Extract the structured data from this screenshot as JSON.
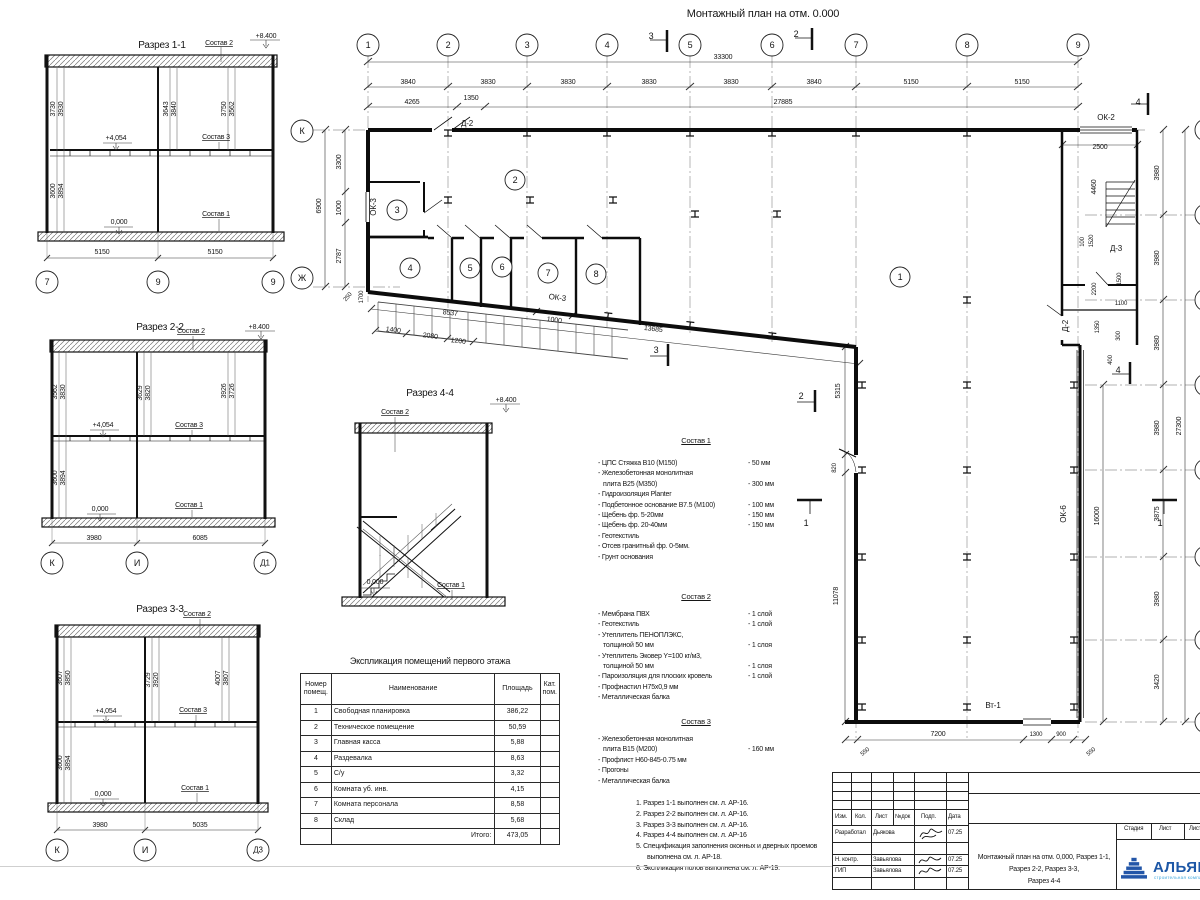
{
  "plan_title": "Монтажный план на отм. 0.000",
  "explication": {
    "title": "Экспликация помещений первого этажа",
    "headers": [
      "Номер помещ.",
      "Наименование",
      "Площадь",
      "Кат. пом."
    ],
    "rows": [
      {
        "n": "1",
        "name": "Свободная планировка",
        "area": "386,22",
        "cat": ""
      },
      {
        "n": "2",
        "name": "Техническое помещение",
        "area": "50,59",
        "cat": ""
      },
      {
        "n": "3",
        "name": "Главная касса",
        "area": "5,88",
        "cat": ""
      },
      {
        "n": "4",
        "name": "Раздевалка",
        "area": "8,63",
        "cat": ""
      },
      {
        "n": "5",
        "name": "С/у",
        "area": "3,32",
        "cat": ""
      },
      {
        "n": "6",
        "name": "Комната уб. инв.",
        "area": "4,15",
        "cat": ""
      },
      {
        "n": "7",
        "name": "Комната персонала",
        "area": "8,58",
        "cat": ""
      },
      {
        "n": "8",
        "name": "Склад",
        "area": "5,68",
        "cat": ""
      },
      {
        "n": "",
        "name": "Итого:",
        "area": "473,05",
        "cat": "",
        "total": 1
      }
    ]
  },
  "sostav1": {
    "title": "Состав 1",
    "items": [
      {
        "t": "- ЦПС Стяжка В10 (М150)",
        "v": "- 50 мм"
      },
      {
        "t": "- Железобетонная монолитная"
      },
      {
        "t": "плита В25 (М350)",
        "v": "- 300 мм",
        "c": 1
      },
      {
        "t": "- Гидроизоляция  Planter"
      },
      {
        "t": "- Подбетонное основание В7.5 (М100)",
        "v": "- 100 мм"
      },
      {
        "t": "- Щебень фр. 5-20мм",
        "v": "- 150 мм"
      },
      {
        "t": "- Щебень фр. 20-40мм",
        "v": "- 150 мм"
      },
      {
        "t": "- Геотекстиль"
      },
      {
        "t": "- Отсев гранитный фр. 0-5мм."
      },
      {
        "t": "- Грунт основания"
      }
    ]
  },
  "sostav2": {
    "title": "Состав 2",
    "items": [
      {
        "t": "- Мембрана ПВХ",
        "v": "- 1 слой"
      },
      {
        "t": "- Геотекстиль",
        "v": "- 1 слой"
      },
      {
        "t": "- Утеплитель ПЕНОПЛЭКС,"
      },
      {
        "t": "толщиной 50 мм",
        "v": "- 1 слоя",
        "c": 1
      },
      {
        "t": "- Утеплитель Эковер Y=100 кг/м3,"
      },
      {
        "t": "толщиной 50 мм",
        "v": "- 1 слоя",
        "c": 1
      },
      {
        "t": "- Пароизоляция для плоских кровель",
        "v": "- 1 слой"
      },
      {
        "t": "- Профнастил Н75х0,9 мм"
      },
      {
        "t": "- Металлическая балка"
      }
    ]
  },
  "sostav3": {
    "title": "Состав 3",
    "items": [
      {
        "t": "- Железобетонная монолитная"
      },
      {
        "t": "плита В15 (М200)",
        "v": "- 160 мм",
        "c": 1
      },
      {
        "t": "- Профлист Н60-845-0.75 мм"
      },
      {
        "t": "- Прогоны"
      },
      {
        "t": "- Металлическая балка"
      }
    ]
  },
  "notes": {
    "items": [
      {
        "t": "1. Разрез 1-1 выполнен см. л. АР-16."
      },
      {
        "t": "2. Разрез 2-2 выполнен см. л. АР-16."
      },
      {
        "t": "3. Разрез 3-3 выполнен см. л. АР-16."
      },
      {
        "t": "4. Разрез 4-4 выполнен см. л. АР-16"
      },
      {
        "t": "5. Спецификация заполнения оконных и дверных проемов выполнена см. л. АР-18."
      },
      {
        "t": "6. Экспликация полов выполнена см. л. АР-19."
      }
    ]
  },
  "titleblock": {
    "cols": [
      "Изм.",
      "Кол.",
      "Лист",
      "№док",
      "Подп.",
      "Дата"
    ],
    "rows": [
      {
        "role": "Разработал",
        "name": "Дьякова",
        "date": "07.25"
      },
      {
        "role": "Н. контр.",
        "name": "Завьялова",
        "date": "07.25"
      },
      {
        "role": "ГИП",
        "name": "Завьялова",
        "date": "07.25"
      }
    ],
    "doc_title": [
      "Монтажный план на отм. 0,000, Разрез 1-1,",
      "Разрез 2-2, Разрез 3-3,",
      "Разрез 4-4"
    ],
    "stage_cols": [
      "Стадия",
      "Лист",
      "Листов"
    ],
    "logo": {
      "name": "АЛЬЯНС",
      "sub": "строительная компания",
      "color": "#1d57a6",
      "sub_color": "#43a9de"
    }
  },
  "svg_texts": {
    "sec11": [
      {
        "t": "Разрез 1-1",
        "x": 162,
        "y": 48,
        "f": 10
      },
      {
        "t": "Состав 2",
        "x": 219,
        "y": 45,
        "u": 1
      },
      {
        "t": "+8.400",
        "x": 266,
        "y": 38
      },
      {
        "t": "3730",
        "x": 55,
        "y": 109,
        "o": -90
      },
      {
        "t": "3930",
        "x": 63,
        "y": 109,
        "o": -90
      },
      {
        "t": "3643",
        "x": 168,
        "y": 109,
        "o": -90
      },
      {
        "t": "3840",
        "x": 176,
        "y": 109,
        "o": -90
      },
      {
        "t": "3750",
        "x": 226,
        "y": 109,
        "o": -90
      },
      {
        "t": "3562",
        "x": 234,
        "y": 109,
        "o": -90
      },
      {
        "t": "+4,054",
        "x": 116,
        "y": 140
      },
      {
        "t": "Состав 3",
        "x": 216,
        "y": 139,
        "u": 1
      },
      {
        "t": "3894",
        "x": 63,
        "y": 191,
        "o": -90
      },
      {
        "t": "3600",
        "x": 55,
        "y": 191,
        "o": -90
      },
      {
        "t": "0,000",
        "x": 119,
        "y": 224
      },
      {
        "t": "Состав 1",
        "x": 216,
        "y": 216,
        "u": 1
      },
      {
        "t": "5150",
        "x": 102,
        "y": 254
      },
      {
        "t": "5150",
        "x": 215,
        "y": 254
      },
      {
        "t": "7",
        "x": 47,
        "y": 282,
        "r": 11,
        "f": 9
      },
      {
        "t": "9",
        "x": 158,
        "y": 282,
        "r": 11,
        "f": 9
      },
      {
        "t": "9",
        "x": 273,
        "y": 282,
        "r": 11,
        "f": 9
      }
    ],
    "sec22": [
      {
        "t": "Разрез 2-2",
        "x": 160,
        "y": 330,
        "f": 10
      },
      {
        "t": "Состав 2",
        "x": 191,
        "y": 333,
        "u": 1
      },
      {
        "t": "+8.400",
        "x": 259,
        "y": 329
      },
      {
        "t": "3562",
        "x": 57,
        "y": 392,
        "o": -90
      },
      {
        "t": "3830",
        "x": 65,
        "y": 392,
        "o": -90
      },
      {
        "t": "3629",
        "x": 142,
        "y": 393,
        "o": -90
      },
      {
        "t": "3820",
        "x": 150,
        "y": 393,
        "o": -90
      },
      {
        "t": "3926",
        "x": 226,
        "y": 391,
        "o": -90
      },
      {
        "t": "3726",
        "x": 234,
        "y": 391,
        "o": -90
      },
      {
        "t": "+4,054",
        "x": 103,
        "y": 427
      },
      {
        "t": "Состав 3",
        "x": 189,
        "y": 427,
        "u": 1
      },
      {
        "t": "3894",
        "x": 65,
        "y": 478,
        "o": -90
      },
      {
        "t": "3600",
        "x": 57,
        "y": 478,
        "o": -90
      },
      {
        "t": "0,000",
        "x": 100,
        "y": 511
      },
      {
        "t": "Состав 1",
        "x": 189,
        "y": 507,
        "u": 1
      },
      {
        "t": "3980",
        "x": 94,
        "y": 540
      },
      {
        "t": "6085",
        "x": 200,
        "y": 540
      },
      {
        "t": "К",
        "x": 52,
        "y": 563,
        "r": 11,
        "f": 9
      },
      {
        "t": "И",
        "x": 137,
        "y": 563,
        "r": 11,
        "f": 9
      },
      {
        "t": "Д1",
        "x": 265,
        "y": 563,
        "r": 11,
        "f": 8
      }
    ],
    "sec33": [
      {
        "t": "Разрез 3-3",
        "x": 160,
        "y": 612,
        "f": 10
      },
      {
        "t": "Состав 2",
        "x": 197,
        "y": 616,
        "u": 1
      },
      {
        "t": "3607",
        "x": 62,
        "y": 678,
        "o": -90
      },
      {
        "t": "3850",
        "x": 70,
        "y": 678,
        "o": -90
      },
      {
        "t": "3729",
        "x": 150,
        "y": 680,
        "o": -90
      },
      {
        "t": "3920",
        "x": 158,
        "y": 680,
        "o": -90
      },
      {
        "t": "4007",
        "x": 220,
        "y": 678,
        "o": -90
      },
      {
        "t": "3807",
        "x": 228,
        "y": 678,
        "o": -90
      },
      {
        "t": "+4,054",
        "x": 106,
        "y": 713
      },
      {
        "t": "Состав 3",
        "x": 193,
        "y": 712,
        "u": 1
      },
      {
        "t": "3894",
        "x": 70,
        "y": 763,
        "o": -90
      },
      {
        "t": "3600",
        "x": 62,
        "y": 763,
        "o": -90
      },
      {
        "t": "0,000",
        "x": 103,
        "y": 796
      },
      {
        "t": "Состав 1",
        "x": 195,
        "y": 790,
        "u": 1
      },
      {
        "t": "3980",
        "x": 100,
        "y": 827
      },
      {
        "t": "5035",
        "x": 200,
        "y": 827
      },
      {
        "t": "К",
        "x": 57,
        "y": 850,
        "r": 11,
        "f": 9
      },
      {
        "t": "И",
        "x": 145,
        "y": 850,
        "r": 11,
        "f": 9
      },
      {
        "t": "Д3",
        "x": 258,
        "y": 850,
        "r": 11,
        "f": 8
      }
    ],
    "sec44": [
      {
        "t": "Разрез 4-4",
        "x": 430,
        "y": 396,
        "f": 10
      },
      {
        "t": "Состав 2",
        "x": 395,
        "y": 414,
        "u": 1
      },
      {
        "t": "+8.400",
        "x": 506,
        "y": 402
      },
      {
        "t": "0,000",
        "x": 375,
        "y": 584
      },
      {
        "t": "Состав 1",
        "x": 451,
        "y": 587,
        "u": 1
      }
    ],
    "plan": [
      {
        "t": "1",
        "x": 368,
        "y": 45,
        "r": 11,
        "f": 9
      },
      {
        "t": "2",
        "x": 448,
        "y": 45,
        "r": 11,
        "f": 9
      },
      {
        "t": "3",
        "x": 527,
        "y": 45,
        "r": 11,
        "f": 9
      },
      {
        "t": "4",
        "x": 607,
        "y": 45,
        "r": 11,
        "f": 9
      },
      {
        "t": "5",
        "x": 690,
        "y": 45,
        "r": 11,
        "f": 9
      },
      {
        "t": "6",
        "x": 772,
        "y": 45,
        "r": 11,
        "f": 9
      },
      {
        "t": "7",
        "x": 856,
        "y": 45,
        "r": 11,
        "f": 9
      },
      {
        "t": "8",
        "x": 967,
        "y": 45,
        "r": 11,
        "f": 9
      },
      {
        "t": "9",
        "x": 1078,
        "y": 45,
        "r": 11,
        "f": 9
      },
      {
        "t": "К",
        "x": 302,
        "y": 131,
        "r": 11,
        "f": 9
      },
      {
        "t": "Ж",
        "x": 302,
        "y": 278,
        "r": 11,
        "f": 9
      },
      {
        "t": "",
        "x": 1206,
        "y": 130,
        "r": 11
      },
      {
        "t": "",
        "x": 1206,
        "y": 215,
        "r": 11
      },
      {
        "t": "",
        "x": 1206,
        "y": 300,
        "r": 11
      },
      {
        "t": "",
        "x": 1206,
        "y": 385,
        "r": 11
      },
      {
        "t": "",
        "x": 1206,
        "y": 470,
        "r": 11
      },
      {
        "t": "",
        "x": 1206,
        "y": 557,
        "r": 11
      },
      {
        "t": "",
        "x": 1206,
        "y": 640,
        "r": 11
      },
      {
        "t": "",
        "x": 1206,
        "y": 722,
        "r": 11
      },
      {
        "t": "1",
        "x": 900,
        "y": 277,
        "r": 10,
        "f": 9
      },
      {
        "t": "2",
        "x": 515,
        "y": 180,
        "r": 10,
        "f": 9
      },
      {
        "t": "3",
        "x": 397,
        "y": 210,
        "r": 10,
        "f": 9
      },
      {
        "t": "4",
        "x": 410,
        "y": 268,
        "r": 10,
        "f": 9
      },
      {
        "t": "5",
        "x": 470,
        "y": 268,
        "r": 10,
        "f": 9
      },
      {
        "t": "6",
        "x": 502,
        "y": 267,
        "r": 10,
        "f": 9
      },
      {
        "t": "7",
        "x": 548,
        "y": 273,
        "r": 10,
        "f": 9
      },
      {
        "t": "8",
        "x": 596,
        "y": 274,
        "r": 10,
        "f": 9
      },
      {
        "t": "33300",
        "x": 723,
        "y": 59
      },
      {
        "t": "3840",
        "x": 408,
        "y": 84
      },
      {
        "t": "3830",
        "x": 488,
        "y": 84
      },
      {
        "t": "3830",
        "x": 568,
        "y": 84
      },
      {
        "t": "3830",
        "x": 649,
        "y": 84
      },
      {
        "t": "3830",
        "x": 731,
        "y": 84
      },
      {
        "t": "3840",
        "x": 814,
        "y": 84
      },
      {
        "t": "5150",
        "x": 911,
        "y": 84
      },
      {
        "t": "5150",
        "x": 1022,
        "y": 84
      },
      {
        "t": "4265",
        "x": 412,
        "y": 104
      },
      {
        "t": "1350",
        "x": 471,
        "y": 100
      },
      {
        "t": "27885",
        "x": 783,
        "y": 104
      },
      {
        "t": "3300",
        "x": 341,
        "y": 162,
        "o": -90
      },
      {
        "t": "1000",
        "x": 341,
        "y": 208,
        "o": -90
      },
      {
        "t": "2787",
        "x": 341,
        "y": 256,
        "o": -90
      },
      {
        "t": "6900",
        "x": 321,
        "y": 206,
        "o": -90
      },
      {
        "t": "250",
        "x": 349,
        "y": 298,
        "o": -50,
        "f": 6
      },
      {
        "t": "1700",
        "x": 363,
        "y": 297,
        "o": -90,
        "f": 6
      },
      {
        "t": "ОК-3",
        "x": 376,
        "y": 207,
        "o": -90,
        "f": 8
      },
      {
        "t": "Д-2",
        "x": 467,
        "y": 126,
        "f": 8
      },
      {
        "t": "1400",
        "x": 393,
        "y": 332,
        "o": 7
      },
      {
        "t": "2080",
        "x": 430,
        "y": 338,
        "o": 7
      },
      {
        "t": "1200",
        "x": 458,
        "y": 343,
        "o": 7
      },
      {
        "t": "8537",
        "x": 450,
        "y": 315,
        "o": 7
      },
      {
        "t": "1000",
        "x": 554,
        "y": 322,
        "o": 7
      },
      {
        "t": "ОК-3",
        "x": 557,
        "y": 300,
        "o": 7,
        "f": 8
      },
      {
        "t": "13685",
        "x": 653,
        "y": 331,
        "o": 7
      },
      {
        "t": "5315",
        "x": 840,
        "y": 391,
        "o": -90
      },
      {
        "t": "820",
        "x": 836,
        "y": 468,
        "o": -90,
        "f": 6
      },
      {
        "t": "11078",
        "x": 838,
        "y": 596,
        "o": -90
      },
      {
        "t": "16000",
        "x": 1099,
        "y": 516,
        "o": -90
      },
      {
        "t": "ОК-6",
        "x": 1066,
        "y": 514,
        "o": -90,
        "f": 8
      },
      {
        "t": "ОК-2",
        "x": 1106,
        "y": 120,
        "f": 8
      },
      {
        "t": "2500",
        "x": 1100,
        "y": 149
      },
      {
        "t": "4460",
        "x": 1096,
        "y": 187,
        "o": -90
      },
      {
        "t": "Д-3",
        "x": 1116,
        "y": 251,
        "f": 8
      },
      {
        "t": "1520",
        "x": 1093,
        "y": 241,
        "o": -90,
        "f": 6
      },
      {
        "t": "100",
        "x": 1084,
        "y": 242,
        "o": -90,
        "f": 6
      },
      {
        "t": "2200",
        "x": 1096,
        "y": 289,
        "o": -90,
        "f": 6
      },
      {
        "t": "1500",
        "x": 1121,
        "y": 279,
        "o": -90,
        "f": 6
      },
      {
        "t": "1100",
        "x": 1121,
        "y": 305,
        "f": 6
      },
      {
        "t": "1350",
        "x": 1099,
        "y": 327,
        "o": -90,
        "f": 6
      },
      {
        "t": "300",
        "x": 1120,
        "y": 336,
        "o": -90,
        "f": 6
      },
      {
        "t": "400",
        "x": 1112,
        "y": 360,
        "o": -90,
        "f": 6
      },
      {
        "t": "Д-2",
        "x": 1068,
        "y": 326,
        "o": -90,
        "f": 8
      },
      {
        "t": "Вт-1",
        "x": 993,
        "y": 708,
        "f": 8
      },
      {
        "t": "550",
        "x": 866,
        "y": 753,
        "o": -40,
        "f": 6
      },
      {
        "t": "7200",
        "x": 938,
        "y": 736
      },
      {
        "t": "1300",
        "x": 1036,
        "y": 736,
        "f": 6
      },
      {
        "t": "900",
        "x": 1061,
        "y": 736,
        "f": 6
      },
      {
        "t": "550",
        "x": 1092,
        "y": 753,
        "o": -40,
        "f": 6
      },
      {
        "t": "3980",
        "x": 1159,
        "y": 173,
        "o": -90
      },
      {
        "t": "3980",
        "x": 1159,
        "y": 258,
        "o": -90
      },
      {
        "t": "3980",
        "x": 1159,
        "y": 343,
        "o": -90
      },
      {
        "t": "3980",
        "x": 1159,
        "y": 428,
        "o": -90
      },
      {
        "t": "3875",
        "x": 1159,
        "y": 514,
        "o": -90
      },
      {
        "t": "3980",
        "x": 1159,
        "y": 599,
        "o": -90
      },
      {
        "t": "3420",
        "x": 1159,
        "y": 682,
        "o": -90
      },
      {
        "t": "27300",
        "x": 1181,
        "y": 426,
        "o": -90
      },
      {
        "t": "3",
        "x": 651,
        "y": 39,
        "f": 9
      },
      {
        "t": "2",
        "x": 796,
        "y": 37,
        "f": 9
      },
      {
        "t": "4",
        "x": 1138,
        "y": 105,
        "f": 9
      },
      {
        "t": "3",
        "x": 656,
        "y": 353,
        "f": 9
      },
      {
        "t": "2",
        "x": 801,
        "y": 399,
        "f": 9
      },
      {
        "t": "1",
        "x": 806,
        "y": 526,
        "f": 9
      },
      {
        "t": "1",
        "x": 1160,
        "y": 526,
        "f": 9
      },
      {
        "t": "4",
        "x": 1118,
        "y": 373,
        "f": 9
      }
    ]
  }
}
